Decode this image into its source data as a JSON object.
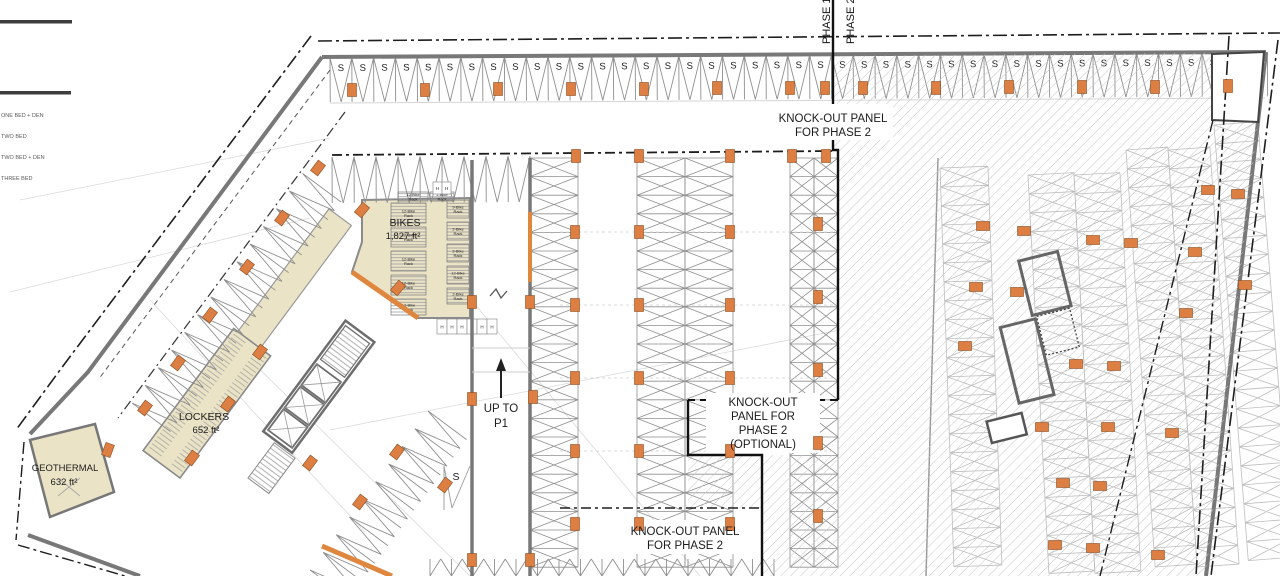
{
  "legend": {
    "items": [
      {
        "label": "ONE BED + DEN"
      },
      {
        "label": "TWO BED"
      },
      {
        "label": "TWO BED + DEN"
      },
      {
        "label": "THREE BED"
      }
    ]
  },
  "labels": {
    "phase1": "PHASE 1",
    "phase2": "PHASE 2",
    "stall": "S",
    "h": "H",
    "ramp_s": "S",
    "knockout_top": {
      "line1": "KNOCK-OUT PANEL",
      "line2": "FOR PHASE 2"
    },
    "knockout_mid": {
      "line1": "KNOCK-OUT",
      "line2": "PANEL FOR",
      "line3": "PHASE 2",
      "line4": "(OPTIONAL)"
    },
    "knockout_bottom": {
      "line1": "KNOCK-OUT PANEL",
      "line2": "FOR PHASE 2"
    },
    "bikes": {
      "name": "BIKES",
      "area": "1,827 ft²"
    },
    "lockers": {
      "name": "LOCKERS",
      "area": "652 ft²"
    },
    "geothermal": {
      "name": "GEOTHERMAL",
      "area": "632 ft²"
    },
    "ramp": {
      "line1": "UP TO",
      "line2": "P1"
    }
  },
  "colors": {
    "room_beige": "#EBE3C6",
    "orange": "#DD7E42",
    "wall_gray": "#787878",
    "hatch": "#C6C6C6",
    "line_dark": "#1E1E1E"
  },
  "plan": {
    "stall_rows": [
      {
        "tx": 330,
        "ty": 58,
        "rot": -0.35,
        "n": 43,
        "w": 21.8,
        "d": 44,
        "s": true
      },
      {
        "tx": 332,
        "ty": 157,
        "rot": -0.3,
        "n": 9,
        "w": 22,
        "d": 46
      },
      {
        "tx": 430,
        "ty": 576,
        "rot": 0,
        "n": 16,
        "w": 21.5,
        "d": -17
      },
      {
        "tx": 132,
        "ty": 403,
        "rot": -53.4,
        "n": 13,
        "w": 22,
        "d": 48
      },
      {
        "tx": 310,
        "ty": 570,
        "rot": -53.4,
        "n": 9,
        "w": 22,
        "d": 48
      }
    ],
    "stall_stacks": [
      {
        "x": 530,
        "y": 158,
        "w": 48,
        "h": 18.6,
        "n": 22
      },
      {
        "x": 637,
        "y": 158,
        "w": 48,
        "h": 18.6,
        "n": 22
      },
      {
        "x": 685,
        "y": 158,
        "w": 48,
        "h": 18.6,
        "n": 22
      },
      {
        "x": 790,
        "y": 158,
        "w": 24,
        "h": 18.6,
        "n": 22
      },
      {
        "x": 814,
        "y": 158,
        "w": 24,
        "h": 18.6,
        "n": 22
      },
      {
        "x": 940,
        "y": 168,
        "w": 48,
        "h": 19,
        "n": 21,
        "f": true,
        "rot": -2
      },
      {
        "x": 1028,
        "y": 175,
        "w": 46,
        "h": 19,
        "n": 21,
        "f": true,
        "rot": -3
      },
      {
        "x": 1074,
        "y": 175,
        "w": 46,
        "h": 19,
        "n": 21,
        "f": true,
        "rot": -3
      },
      {
        "x": 1126,
        "y": 150,
        "w": 42,
        "h": 19,
        "n": 22,
        "f": true,
        "rot": -4
      },
      {
        "x": 1168,
        "y": 150,
        "w": 42,
        "h": 19,
        "n": 22,
        "f": true,
        "rot": -4
      },
      {
        "x": 1214,
        "y": 125,
        "w": 44,
        "h": 19,
        "n": 23,
        "f": true,
        "rot": -4.5
      }
    ],
    "columns": [
      [
        352,
        90
      ],
      [
        425,
        90
      ],
      [
        498,
        89
      ],
      [
        571,
        89
      ],
      [
        644,
        89
      ],
      [
        717,
        88
      ],
      [
        790,
        88
      ],
      [
        825,
        88
      ],
      [
        863,
        88
      ],
      [
        936,
        88
      ],
      [
        1009,
        87
      ],
      [
        1082,
        87
      ],
      [
        1155,
        87
      ],
      [
        1228,
        86
      ],
      [
        576,
        156
      ],
      [
        639,
        156
      ],
      [
        730,
        156
      ],
      [
        792,
        156
      ],
      [
        826,
        156
      ],
      [
        575,
        232
      ],
      [
        575,
        305
      ],
      [
        575,
        378
      ],
      [
        575,
        451
      ],
      [
        575,
        524
      ],
      [
        639,
        232
      ],
      [
        639,
        305
      ],
      [
        639,
        378
      ],
      [
        639,
        451
      ],
      [
        639,
        524
      ],
      [
        730,
        232
      ],
      [
        730,
        305
      ],
      [
        730,
        378
      ],
      [
        730,
        451
      ],
      [
        730,
        524
      ],
      [
        818,
        224
      ],
      [
        818,
        297
      ],
      [
        818,
        370
      ],
      [
        818,
        443
      ],
      [
        818,
        516
      ],
      [
        472,
        302
      ],
      [
        530,
        302
      ],
      [
        472,
        399
      ],
      [
        533,
        397
      ],
      [
        472,
        560
      ],
      [
        530,
        560
      ],
      [
        318,
        168,
        37
      ],
      [
        282,
        218,
        37
      ],
      [
        247,
        267,
        37
      ],
      [
        210,
        315,
        37
      ],
      [
        178,
        363,
        37
      ],
      [
        145,
        408,
        37
      ],
      [
        310,
        463,
        37
      ],
      [
        360,
        502,
        37
      ],
      [
        397,
        452,
        37
      ],
      [
        445,
        485,
        37
      ],
      [
        260,
        352,
        37
      ],
      [
        228,
        404,
        37
      ],
      [
        192,
        458,
        37
      ],
      [
        108,
        450,
        20
      ],
      [
        362,
        210,
        40
      ],
      [
        398,
        288,
        40
      ],
      [
        983,
        226,
        90
      ],
      [
        1024,
        231,
        90
      ],
      [
        976,
        287,
        90
      ],
      [
        1017,
        292,
        90
      ],
      [
        965,
        346,
        90
      ],
      [
        1093,
        240,
        90
      ],
      [
        1131,
        243,
        90
      ],
      [
        1195,
        252,
        90
      ],
      [
        1186,
        313,
        90
      ],
      [
        1076,
        364,
        90
      ],
      [
        1114,
        366,
        90
      ],
      [
        1042,
        427,
        90
      ],
      [
        1108,
        427,
        90
      ],
      [
        1172,
        433,
        90
      ],
      [
        1063,
        483,
        90
      ],
      [
        1100,
        486,
        90
      ],
      [
        1055,
        545,
        90
      ],
      [
        1093,
        548,
        90
      ],
      [
        1158,
        555,
        90
      ],
      [
        1238,
        194,
        90
      ],
      [
        1245,
        285,
        90
      ],
      [
        1208,
        190,
        90
      ]
    ],
    "bike_racks": [
      {
        "x": 398,
        "y": 192,
        "w": 30,
        "h": 9,
        "label": "12-Bike Rack"
      },
      {
        "x": 430,
        "y": 192,
        "w": 24,
        "h": 9,
        "label": "2-Bike Rack"
      },
      {
        "x": 391,
        "y": 203,
        "w": 35,
        "h": 20,
        "label": "12-Bike Rack"
      },
      {
        "x": 391,
        "y": 227,
        "w": 35,
        "h": 20,
        "label": "12-Bike Rack"
      },
      {
        "x": 391,
        "y": 251,
        "w": 35,
        "h": 20,
        "label": "12-Bike Rack"
      },
      {
        "x": 391,
        "y": 275,
        "w": 35,
        "h": 20,
        "label": "12-Bike Rack"
      },
      {
        "x": 391,
        "y": 299,
        "w": 35,
        "h": 16,
        "label": "12-Bike Rack"
      },
      {
        "x": 447,
        "y": 200,
        "w": 22,
        "h": 18,
        "label": "9-Bike Rack"
      },
      {
        "x": 447,
        "y": 222,
        "w": 22,
        "h": 18,
        "label": "2-Bike Rack"
      },
      {
        "x": 447,
        "y": 244,
        "w": 22,
        "h": 18,
        "label": "2-Bike Rack"
      },
      {
        "x": 447,
        "y": 266,
        "w": 22,
        "h": 18,
        "label": "12-Bike Rack"
      },
      {
        "x": 447,
        "y": 288,
        "w": 22,
        "h": 16,
        "label": "2-Bike Rack"
      }
    ],
    "h_strips": [
      {
        "x": 433,
        "y": 182,
        "n": 2,
        "w": 9,
        "h": 12
      },
      {
        "x": 437,
        "y": 319,
        "n": 6,
        "w": 10,
        "h": 15
      }
    ]
  }
}
